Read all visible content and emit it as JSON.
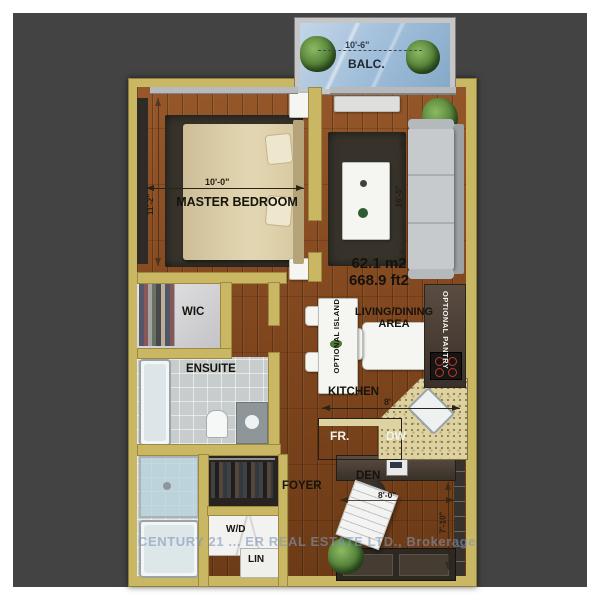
{
  "page": {
    "watermark": "CENTURY 21 ... ER REAL ESTATE LTD., Brokerage"
  },
  "unit": {
    "area_m2": "62.1 m2",
    "area_ft2": "668.9 ft2"
  },
  "rooms": {
    "balcony": {
      "label": "BALC.",
      "width": "10'-6\""
    },
    "master_bedroom": {
      "label": "MASTER BEDROOM",
      "width": "10'-0\"",
      "depth": "11'-2\""
    },
    "living_dining": {
      "label": "LIVING/DINING AREA",
      "depth": "16'-5\""
    },
    "wic": {
      "label": "WIC"
    },
    "ensuite": {
      "label": "ENSUITE"
    },
    "kitchen": {
      "label": "KITCHEN",
      "width": "8'"
    },
    "optional_island": {
      "label": "OPTIONAL ISLAND"
    },
    "optional_pantry": {
      "label": "OPTIONAL PANTRY"
    },
    "fridge": {
      "label": "FR."
    },
    "dishwasher": {
      "label": "DW"
    },
    "foyer": {
      "label": "FOYER"
    },
    "den": {
      "label": "DEN",
      "width": "8'-0\"",
      "depth": "7'-10\""
    },
    "washer_dryer": {
      "label": "W/D"
    },
    "linen": {
      "label": "LIN"
    }
  },
  "colors": {
    "background": "#434343",
    "wall": "#c9b763",
    "floor_wood": "#7d4a22",
    "rug": "#37332b",
    "watermark_blue": "#8096b6"
  }
}
